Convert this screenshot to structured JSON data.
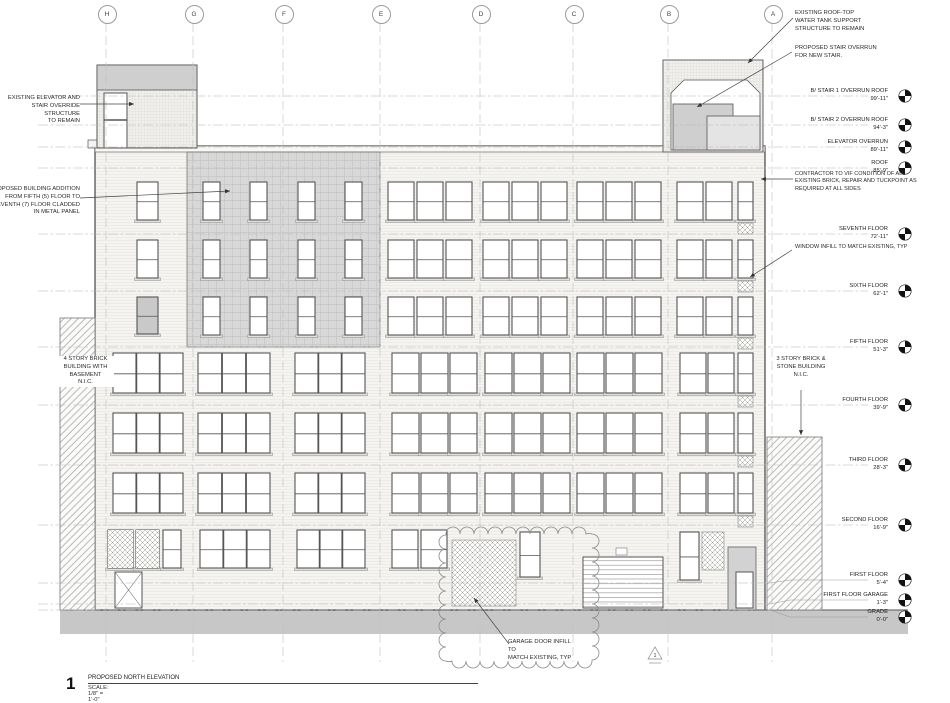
{
  "drawing": {
    "grid_columns": [
      "H",
      "G",
      "F",
      "E",
      "D",
      "C",
      "B",
      "A"
    ],
    "levels": [
      {
        "name": "B/ STAIR 1 OVERRUN ROOF",
        "elev": "99'-11\""
      },
      {
        "name": "B/ STAIR 2 OVERRUN ROOF",
        "elev": "94'-3\""
      },
      {
        "name": "ELEVATOR OVERRUN",
        "elev": "89'-11\""
      },
      {
        "name": "ROOF",
        "elev": "85'-9\""
      },
      {
        "name": "SEVENTH FLOOR",
        "elev": "72'-11\""
      },
      {
        "name": "SIXTH FLOOR",
        "elev": "62'-1\""
      },
      {
        "name": "FIFTH FLOOR",
        "elev": "51'-3\""
      },
      {
        "name": "FOURTH FLOOR",
        "elev": "39'-9\""
      },
      {
        "name": "THIRD FLOOR",
        "elev": "28'-3\""
      },
      {
        "name": "SECOND FLOOR",
        "elev": "16'-9\""
      },
      {
        "name": "FIRST FLOOR",
        "elev": "5'-4\""
      },
      {
        "name": "FIRST FLOOR GARAGE",
        "elev": "1'-3\""
      },
      {
        "name": "GRADE",
        "elev": "0'-0\""
      }
    ],
    "annotations": {
      "existing_elevator": "EXISTING ELEVATOR AND\nSTAIR OVERRIDE STRUCTURE\nTO REMAIN",
      "proposed_addition": "PROPOSED BUILDING ADDITION\nFROM FIFTH (5) FLOOR TO\nSEVENTH (7) FLOOR CLADDED\nIN METAL PANEL",
      "four_story": "4 STORY BRICK\nBUILDING WITH\nBASEMENT\nN.I.C.",
      "water_tank": "EXISTING ROOF-TOP\nWATER TANK SUPPORT\nSTRUCTURE TO REMAIN",
      "stair_overrun": "PROPOSED STAIR OVERRUN\nFOR NEW STAIR.",
      "contractor_vif": "CONTRACTOR TO VIF CONDITION OF ALL\nEXISTING BRICK, REPAIR AND TUCKPOINT AS\nREQUIRED AT ALL SIDES",
      "window_infill": "WINDOW INFILL TO MATCH EXISTING, TYP",
      "three_story": "3 STORY BRICK &\nSTONE BUILDING\nN.I.C.",
      "garage_infill": "GARAGE DOOR INFILL TO\nMATCH EXISTING, TYP"
    },
    "revision_marker": "1",
    "title_block": {
      "number": "1",
      "title": "PROPOSED NORTH ELEVATION",
      "scale": "SCALE:  1/8\" = 1'-0\""
    }
  }
}
